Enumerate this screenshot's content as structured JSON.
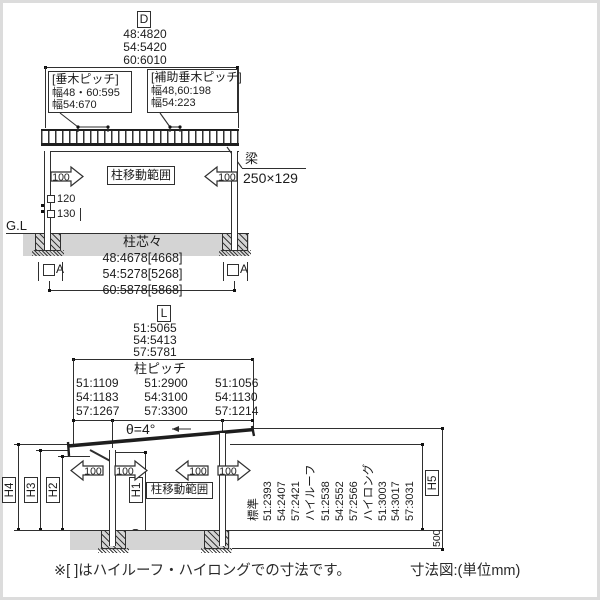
{
  "page": {
    "note": "※[ ]はハイルーフ・ハイロングでの寸法です。",
    "caption": "寸法図:(単位mm)",
    "line_color": "#2f2f2f",
    "ground_color": "#d4d4d4"
  },
  "front_view": {
    "axis": "D",
    "overall_dims": [
      "48:4820",
      "54:5420",
      "60:6010"
    ],
    "rafter_pitch": {
      "title": "[垂木ピッチ]",
      "l1": "幅48・60:595",
      "l2": "幅54:670"
    },
    "aux_rafter_pitch": {
      "title": "[補助垂木ピッチ]",
      "l1": "幅48,60:198",
      "l2": "幅54:223"
    },
    "beam": {
      "name": "梁",
      "size": "250×129"
    },
    "move_range": "柱移動範囲",
    "arrow_value": "100",
    "post_size_std": "120",
    "post_size_alt": "130",
    "gl": "G.L",
    "span": {
      "title": "柱芯々",
      "dims": [
        "48:4678[4668]",
        "54:5278[5268]",
        "60:5878[5868]"
      ]
    },
    "anchor": "A"
  },
  "side_view": {
    "axis": "L",
    "overall_dims": [
      "51:5065",
      "54:5413",
      "57:5781"
    ],
    "pitch_title": "柱ピッチ",
    "rear_dims": [
      "51:1109",
      "54:1183",
      "57:1267"
    ],
    "mid_dims": [
      "51:2900",
      "54:3100",
      "57:3300"
    ],
    "front_dims": [
      "51:1056",
      "54:1130",
      "57:1214"
    ],
    "angle": "θ=4°",
    "arrow_value": "100",
    "move_range": "柱移動範囲",
    "h_labels": {
      "h1": "H1",
      "h2": "H2",
      "h3": "H3",
      "h4": "H4",
      "h5": "H5"
    },
    "embed_depth": "500",
    "heights": [
      "標準",
      "51:2393",
      "54:2407",
      "57:2421",
      "ハイルーフ",
      "51:2538",
      "54:2552",
      "57:2566",
      "ハイロング",
      "51:3003",
      "54:3017",
      "57:3031"
    ]
  }
}
